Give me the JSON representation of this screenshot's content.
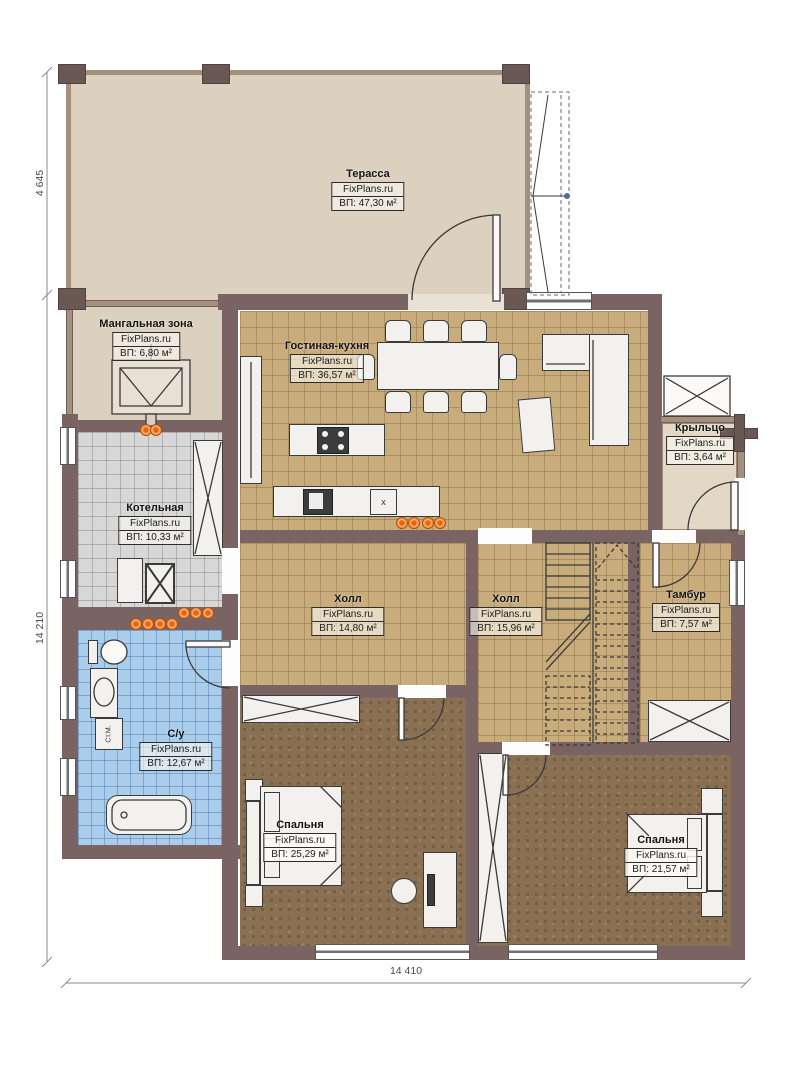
{
  "brand": "FixPlans.ru",
  "rooms": [
    {
      "id": "terrace",
      "name": "Терасса",
      "area": "ВП: 47,30 м²"
    },
    {
      "id": "bbq-zone",
      "name": "Мангальная зона",
      "area": "ВП: 6,80 м²"
    },
    {
      "id": "living-kitchen",
      "name": "Гостиная-кухня",
      "area": "ВП: 36,57 м²"
    },
    {
      "id": "porch",
      "name": "Крыльцо",
      "area": "ВП: 3,64 м²"
    },
    {
      "id": "boiler-room",
      "name": "Котельная",
      "area": "ВП: 10,33 м²"
    },
    {
      "id": "hall-1",
      "name": "Холл",
      "area": "ВП: 14,80 м²"
    },
    {
      "id": "hall-2",
      "name": "Холл",
      "area": "ВП: 15,96 м²"
    },
    {
      "id": "tambour",
      "name": "Тамбур",
      "area": "ВП: 7,57 м²"
    },
    {
      "id": "bathroom",
      "name": "С/у",
      "area": "ВП: 12,67 м²"
    },
    {
      "id": "bedroom-left",
      "name": "Спальня",
      "area": "ВП: 25,29 м²"
    },
    {
      "id": "bedroom-right",
      "name": "Спальня",
      "area": "ВП: 21,57 м²"
    }
  ],
  "dimensions": {
    "left_top": "4 645",
    "left_side": "14 210",
    "bottom": "14 410"
  },
  "appliances": {
    "washing_machine": "Ст.М.",
    "dishwasher_mark": "x"
  },
  "colors": {
    "wall": "#7a6463",
    "tile_floor": "#c9ac7c",
    "boiler_floor": "#d7d7d7",
    "bath_floor": "#aacdec",
    "carpet": "#8a7053",
    "terrace_floor": "#dcd0be",
    "radiator": "#ef8430"
  }
}
